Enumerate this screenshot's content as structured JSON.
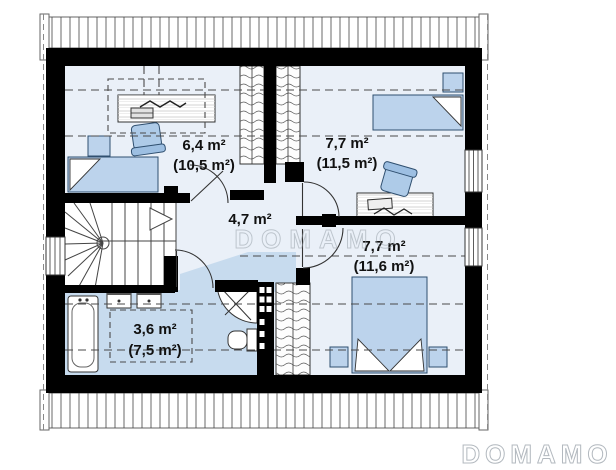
{
  "watermark": {
    "text": "DOMAMO"
  },
  "brand_logo": {
    "text": "DOMAMO"
  },
  "rooms": [
    {
      "name": "room-top-left",
      "area": "6,4 m²",
      "total": "(10,5 m²)"
    },
    {
      "name": "room-top-right",
      "area": "7,7 m²",
      "total": "(11,5 m²)"
    },
    {
      "name": "hall",
      "area": "4,7 m²",
      "total": ""
    },
    {
      "name": "bedroom-bottom",
      "area": "7,7 m²",
      "total": "(11,6 m²)"
    },
    {
      "name": "bathroom",
      "area": "3,6 m²",
      "total": "(7,5 m²)"
    }
  ],
  "colors": {
    "wall": "#000000",
    "floor_light": "#eaf0f8",
    "floor_wet": "#c7dbee",
    "furniture_blue": "#bcd3ec",
    "furniture_outline": "#2f4f6f",
    "watermark_gray": "#9aa3ab"
  }
}
